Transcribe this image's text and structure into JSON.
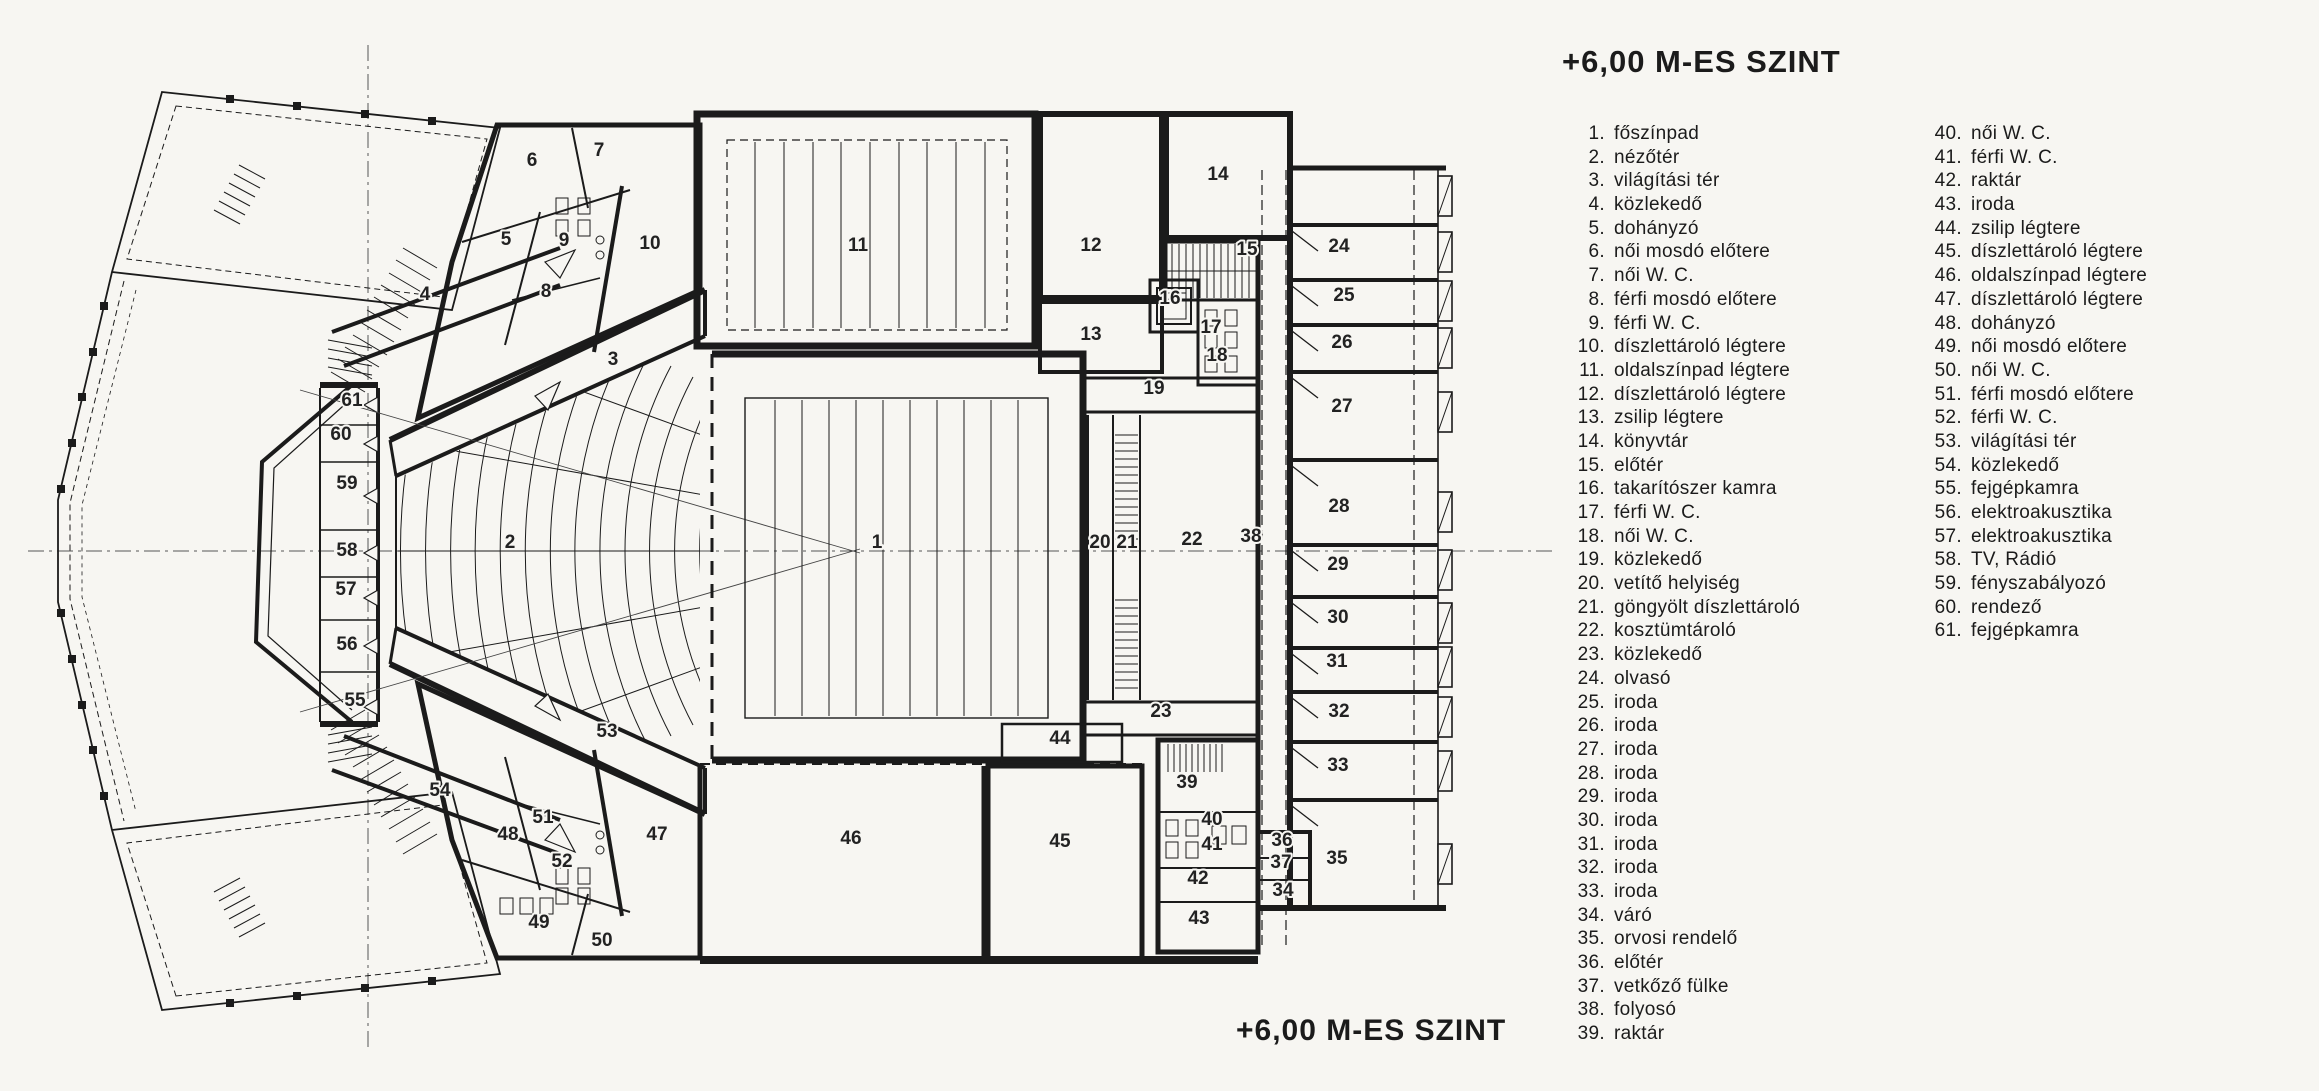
{
  "title": "+6,00 M-ES SZINT",
  "caption": "+6,00 M-ES SZINT",
  "legend": {
    "column1": [
      {
        "n": "1.",
        "label": "főszínpad"
      },
      {
        "n": "2.",
        "label": "nézőtér"
      },
      {
        "n": "3.",
        "label": "világítási tér"
      },
      {
        "n": "4.",
        "label": "közlekedő"
      },
      {
        "n": "5.",
        "label": "dohányzó"
      },
      {
        "n": "6.",
        "label": "női mosdó előtere"
      },
      {
        "n": "7.",
        "label": "női W. C."
      },
      {
        "n": "8.",
        "label": "férfi mosdó előtere"
      },
      {
        "n": "9.",
        "label": "férfi W. C."
      },
      {
        "n": "10.",
        "label": "díszlettároló légtere"
      },
      {
        "n": "11.",
        "label": "oldalszínpad légtere"
      },
      {
        "n": "12.",
        "label": "díszlettároló légtere"
      },
      {
        "n": "13.",
        "label": "zsilip légtere"
      },
      {
        "n": "14.",
        "label": "könyvtár"
      },
      {
        "n": "15.",
        "label": "előtér"
      },
      {
        "n": "16.",
        "label": "takarítószer kamra"
      },
      {
        "n": "17.",
        "label": "férfi W. C."
      },
      {
        "n": "18.",
        "label": "női W. C."
      },
      {
        "n": "19.",
        "label": "közlekedő"
      },
      {
        "n": "20.",
        "label": "vetítő helyiség"
      },
      {
        "n": "21.",
        "label": "göngyölt díszlettároló"
      },
      {
        "n": "22.",
        "label": "kosztümtároló"
      },
      {
        "n": "23.",
        "label": "közlekedő"
      },
      {
        "n": "24.",
        "label": "olvasó"
      },
      {
        "n": "25.",
        "label": "iroda"
      },
      {
        "n": "26.",
        "label": "iroda"
      },
      {
        "n": "27.",
        "label": "iroda"
      },
      {
        "n": "28.",
        "label": "iroda"
      },
      {
        "n": "29.",
        "label": "iroda"
      },
      {
        "n": "30.",
        "label": "iroda"
      },
      {
        "n": "31.",
        "label": "iroda"
      },
      {
        "n": "32.",
        "label": "iroda"
      },
      {
        "n": "33.",
        "label": "iroda"
      },
      {
        "n": "34.",
        "label": "váró"
      },
      {
        "n": "35.",
        "label": "orvosi rendelő"
      },
      {
        "n": "36.",
        "label": "előtér"
      },
      {
        "n": "37.",
        "label": "vetkőző fülke"
      },
      {
        "n": "38.",
        "label": "folyosó"
      },
      {
        "n": "39.",
        "label": "raktár"
      }
    ],
    "column2": [
      {
        "n": "40.",
        "label": "női W. C."
      },
      {
        "n": "41.",
        "label": "férfi W. C."
      },
      {
        "n": "42.",
        "label": "raktár"
      },
      {
        "n": "43.",
        "label": "iroda"
      },
      {
        "n": "44.",
        "label": "zsilip légtere"
      },
      {
        "n": "45.",
        "label": "díszlettároló légtere"
      },
      {
        "n": "46.",
        "label": "oldalszínpad légtere"
      },
      {
        "n": "47.",
        "label": "díszlettároló légtere"
      },
      {
        "n": "48.",
        "label": "dohányzó"
      },
      {
        "n": "49.",
        "label": "női mosdó előtere"
      },
      {
        "n": "50.",
        "label": "női W. C."
      },
      {
        "n": "51.",
        "label": "férfi mosdó előtere"
      },
      {
        "n": "52.",
        "label": "férfi W. C."
      },
      {
        "n": "53.",
        "label": "világítási tér"
      },
      {
        "n": "54.",
        "label": "közlekedő"
      },
      {
        "n": "55.",
        "label": "fejgépkamra"
      },
      {
        "n": "56.",
        "label": "elektroakusztika"
      },
      {
        "n": "57.",
        "label": "elektroakusztika"
      },
      {
        "n": "58.",
        "label": "TV, Rádió"
      },
      {
        "n": "59.",
        "label": "fényszabályozó"
      },
      {
        "n": "60.",
        "label": "rendező"
      },
      {
        "n": "61.",
        "label": "fejgépkamra"
      }
    ]
  },
  "plan_labels": [
    {
      "n": "1",
      "x": 877,
      "y": 548
    },
    {
      "n": "2",
      "x": 510,
      "y": 548
    },
    {
      "n": "3",
      "x": 613,
      "y": 365
    },
    {
      "n": "4",
      "x": 425,
      "y": 300
    },
    {
      "n": "5",
      "x": 506,
      "y": 245
    },
    {
      "n": "6",
      "x": 532,
      "y": 166
    },
    {
      "n": "7",
      "x": 599,
      "y": 156
    },
    {
      "n": "8",
      "x": 546,
      "y": 297
    },
    {
      "n": "9",
      "x": 564,
      "y": 246
    },
    {
      "n": "10",
      "x": 650,
      "y": 249
    },
    {
      "n": "11",
      "x": 858,
      "y": 251
    },
    {
      "n": "12",
      "x": 1091,
      "y": 251
    },
    {
      "n": "13",
      "x": 1091,
      "y": 340
    },
    {
      "n": "14",
      "x": 1218,
      "y": 180
    },
    {
      "n": "15",
      "x": 1247,
      "y": 255
    },
    {
      "n": "16",
      "x": 1170,
      "y": 304
    },
    {
      "n": "17",
      "x": 1211,
      "y": 333
    },
    {
      "n": "18",
      "x": 1217,
      "y": 361
    },
    {
      "n": "19",
      "x": 1154,
      "y": 394
    },
    {
      "n": "20",
      "x": 1100,
      "y": 548
    },
    {
      "n": "21",
      "x": 1127,
      "y": 548
    },
    {
      "n": "22",
      "x": 1192,
      "y": 545
    },
    {
      "n": "23",
      "x": 1161,
      "y": 717
    },
    {
      "n": "24",
      "x": 1339,
      "y": 252
    },
    {
      "n": "25",
      "x": 1344,
      "y": 301
    },
    {
      "n": "26",
      "x": 1342,
      "y": 348
    },
    {
      "n": "27",
      "x": 1342,
      "y": 412
    },
    {
      "n": "28",
      "x": 1339,
      "y": 512
    },
    {
      "n": "29",
      "x": 1338,
      "y": 570
    },
    {
      "n": "30",
      "x": 1338,
      "y": 623
    },
    {
      "n": "31",
      "x": 1337,
      "y": 667
    },
    {
      "n": "32",
      "x": 1339,
      "y": 717
    },
    {
      "n": "33",
      "x": 1338,
      "y": 771
    },
    {
      "n": "34",
      "x": 1283,
      "y": 896
    },
    {
      "n": "35",
      "x": 1337,
      "y": 864
    },
    {
      "n": "36",
      "x": 1282,
      "y": 846
    },
    {
      "n": "37",
      "x": 1281,
      "y": 868
    },
    {
      "n": "38",
      "x": 1251,
      "y": 542
    },
    {
      "n": "39",
      "x": 1187,
      "y": 788
    },
    {
      "n": "40",
      "x": 1212,
      "y": 825
    },
    {
      "n": "41",
      "x": 1212,
      "y": 850
    },
    {
      "n": "42",
      "x": 1198,
      "y": 884
    },
    {
      "n": "43",
      "x": 1199,
      "y": 924
    },
    {
      "n": "44",
      "x": 1060,
      "y": 744
    },
    {
      "n": "45",
      "x": 1060,
      "y": 847
    },
    {
      "n": "46",
      "x": 851,
      "y": 844
    },
    {
      "n": "47",
      "x": 657,
      "y": 840
    },
    {
      "n": "48",
      "x": 508,
      "y": 840
    },
    {
      "n": "49",
      "x": 539,
      "y": 928
    },
    {
      "n": "50",
      "x": 602,
      "y": 946
    },
    {
      "n": "51",
      "x": 543,
      "y": 823
    },
    {
      "n": "52",
      "x": 562,
      "y": 867
    },
    {
      "n": "53",
      "x": 607,
      "y": 737
    },
    {
      "n": "54",
      "x": 440,
      "y": 796
    },
    {
      "n": "55",
      "x": 355,
      "y": 706
    },
    {
      "n": "56",
      "x": 347,
      "y": 650
    },
    {
      "n": "57",
      "x": 346,
      "y": 595
    },
    {
      "n": "58",
      "x": 347,
      "y": 556
    },
    {
      "n": "59",
      "x": 347,
      "y": 489
    },
    {
      "n": "60",
      "x": 341,
      "y": 440
    },
    {
      "n": "61",
      "x": 352,
      "y": 406
    }
  ]
}
